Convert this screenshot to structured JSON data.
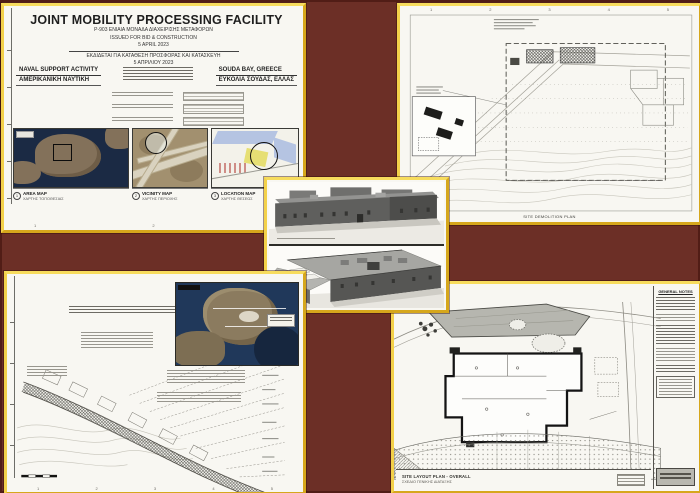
{
  "page": {
    "background": "#6c2f26",
    "panel_border": "#eec42c"
  },
  "title_sheet": {
    "title": "JOINT MOBILITY PROCESSING FACILITY",
    "line1": "P-903 ΕΝΙΑΙΑ ΜΟΝΑΔΑ ΔΙΑΧΕΙΡΙΣΗΣ ΜΕΤΑΦΟΡΩΝ",
    "line2": "ISSUED FOR BID & CONSTRUCTION",
    "line3": "5 APRIL 2023",
    "line4": "ΕΚΔΙΔΕΤΑΙ ΓΙΑ ΚΑΤΑΘΕΣΗ ΠΡΟΣΦΟΡΑΣ ΚΑΙ ΚΑΤΑΣΚΕΥΗ",
    "line5": "5 ΑΠΡΙΛΙΟΥ 2023",
    "agency_en": "NAVAL SUPPORT ACTIVITY",
    "agency_gr": "ΑΜΕΡΙΚΑΝΙΚΗ ΝΑΥΤΙΚΗ",
    "location_en": "SOUDA BAY, GREECE",
    "location_gr": "ΕΥΚΟΛΙΑ ΣΟΥΔΑΣ, ΕΛΛΑΣ",
    "maps": [
      {
        "fig": "1",
        "label": "AREA MAP",
        "sublabel": "ΧΑΡΤΗΣ ΤΟΠΟΘΕΣΙΑΣ"
      },
      {
        "fig": "2",
        "label": "VICINITY MAP",
        "sublabel": "ΧΑΡΤΗΣ ΠΕΡΙΟΧΗΣ"
      },
      {
        "fig": "3",
        "label": "LOCATION MAP",
        "sublabel": "ΧΑΡΤΗΣ ΘΕΣΕΩΣ"
      }
    ],
    "ticks": [
      "1",
      "2",
      "3"
    ]
  },
  "demolition_sheet": {
    "caption": "SITE DEMOLITION PLAN",
    "ticks": [
      "1",
      "2",
      "3",
      "4",
      "5"
    ]
  },
  "road_sheet": {
    "ticks": [
      "1",
      "2",
      "3",
      "4",
      "5"
    ]
  },
  "layout_sheet": {
    "notes_title": "GENERAL NOTES",
    "caption_en": "SITE LAYOUT PLAN - OVERALL",
    "caption_gr": "ΣΧΕΔΙΟ ΓΕΝΙΚΗΣ ΔΙΑΤΑΞΗΣ"
  }
}
